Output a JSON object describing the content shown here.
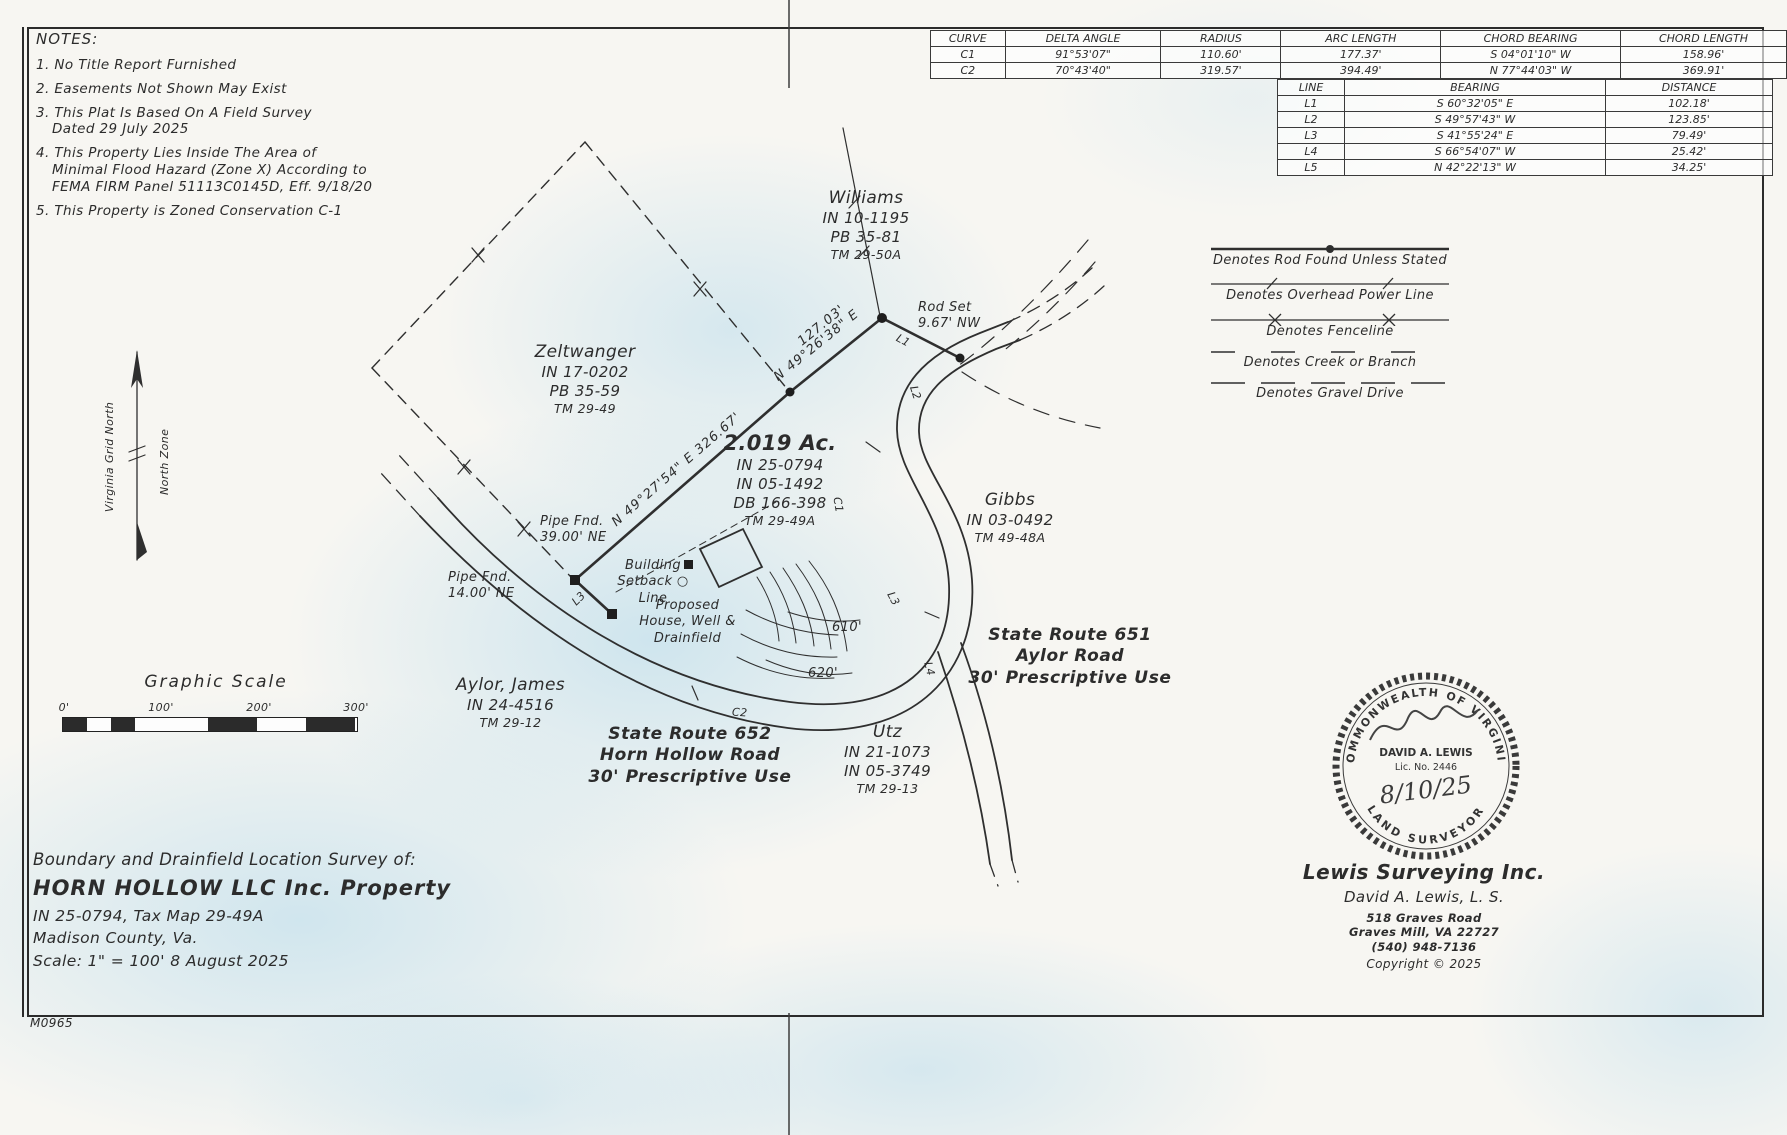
{
  "sheet": {
    "id": "M0965"
  },
  "notes": {
    "title": "NOTES:",
    "items": [
      "1. No Title Report Furnished",
      "2. Easements Not Shown May Exist",
      "3. This Plat Is Based On A Field Survey\nDated 29 July 2025",
      "4. This Property Lies Inside The Area of\nMinimal Flood Hazard (Zone X) According to\nFEMA FIRM Panel 51113C0145D, Eff. 9/18/20",
      "5. This Property is Zoned Conservation C-1"
    ]
  },
  "curve_table": {
    "headers": [
      "CURVE",
      "DELTA ANGLE",
      "RADIUS",
      "ARC LENGTH",
      "CHORD BEARING",
      "CHORD LENGTH"
    ],
    "rows": [
      [
        "C1",
        "91°53'07\"",
        "110.60'",
        "177.37'",
        "S 04°01'10\" W",
        "158.96'"
      ],
      [
        "C2",
        "70°43'40\"",
        "319.57'",
        "394.49'",
        "N 77°44'03\" W",
        "369.91'"
      ]
    ]
  },
  "line_table": {
    "headers": [
      "LINE",
      "BEARING",
      "DISTANCE"
    ],
    "rows": [
      [
        "L1",
        "S 60°32'05\" E",
        "102.18'"
      ],
      [
        "L2",
        "S 49°57'43\" W",
        "123.85'"
      ],
      [
        "L3",
        "S 41°55'24\" E",
        "79.49'"
      ],
      [
        "L4",
        "S 66°54'07\" W",
        "25.42'"
      ],
      [
        "L5",
        "N 42°22'13\" W",
        "34.25'"
      ]
    ]
  },
  "legend": {
    "items": [
      "Denotes Rod Found Unless Stated",
      "Denotes Overhead Power Line",
      "Denotes Fenceline",
      "Denotes Creek or Branch",
      "Denotes Gravel Drive"
    ]
  },
  "north_arrow": {
    "left_label": "Virginia Grid North",
    "right_label": "North Zone"
  },
  "scale_bar": {
    "title": "Graphic Scale",
    "ticks": [
      "0'",
      "100'",
      "200'",
      "300'"
    ]
  },
  "map": {
    "parcels": {
      "williams": [
        "Williams",
        "IN 10-1195",
        "PB 35-81",
        "TM 29-50A"
      ],
      "zeltwanger": [
        "Zeltwanger",
        "IN 17-0202",
        "PB 35-59",
        "TM 29-49"
      ],
      "subject": [
        "2.019 Ac.",
        "IN 25-0794",
        "IN 05-1492",
        "DB 166-398",
        "TM 29-49A"
      ],
      "gibbs": [
        "Gibbs",
        "IN 03-0492",
        "TM 49-48A"
      ],
      "aylor": [
        "Aylor, James",
        "IN 24-4516",
        "TM 29-12"
      ],
      "utz": [
        "Utz",
        "IN 21-1073",
        "IN 05-3749",
        "TM 29-13"
      ]
    },
    "roads": {
      "route651": [
        "State Route 651",
        "Aylor Road",
        "30' Prescriptive Use"
      ],
      "route652": [
        "State Route 652",
        "Horn Hollow Road",
        "30' Prescriptive Use"
      ]
    },
    "ann": {
      "rod_set": "Rod Set\n9.67' NW",
      "pipe39": "Pipe Fnd.\n39.00' NE",
      "pipe14": "Pipe Fnd.\n14.00' NE",
      "setback": "Building\nSetback ○\nLine",
      "proposed": "Proposed\nHouse, Well &\nDrainfield",
      "main_bearing": "N 49°27'54\" E   326.67'",
      "dist127": "127.03'",
      "brg4926": "N 49°26'38\" E",
      "c610": "610'",
      "c620": "620'",
      "L1": "L1",
      "L2": "L2",
      "L3": "L3",
      "L4": "L4",
      "C1": "C1",
      "C2": "C2"
    }
  },
  "title_block": {
    "line1": "Boundary and Drainfield Location Survey of:",
    "line2": "HORN HOLLOW LLC Inc. Property",
    "line3": "IN 25-0794, Tax Map 29-49A",
    "line4": "Madison County, Va.",
    "line5": "Scale: 1\" = 100'    8 August 2025"
  },
  "seal": {
    "top": "COMMONWEALTH OF VIRGINIA",
    "bottom": "LAND SURVEYOR",
    "name": "DAVID A. LEWIS",
    "lic": "Lic. No. 2446",
    "date": "8/10/25"
  },
  "firm": {
    "name": "Lewis Surveying Inc.",
    "surveyor": "David A. Lewis, L. S.",
    "address1": "518 Graves Road",
    "address2": "Graves Mill, VA 22727",
    "phone": "(540) 948-7136",
    "copyright": "Copyright © 2025"
  }
}
